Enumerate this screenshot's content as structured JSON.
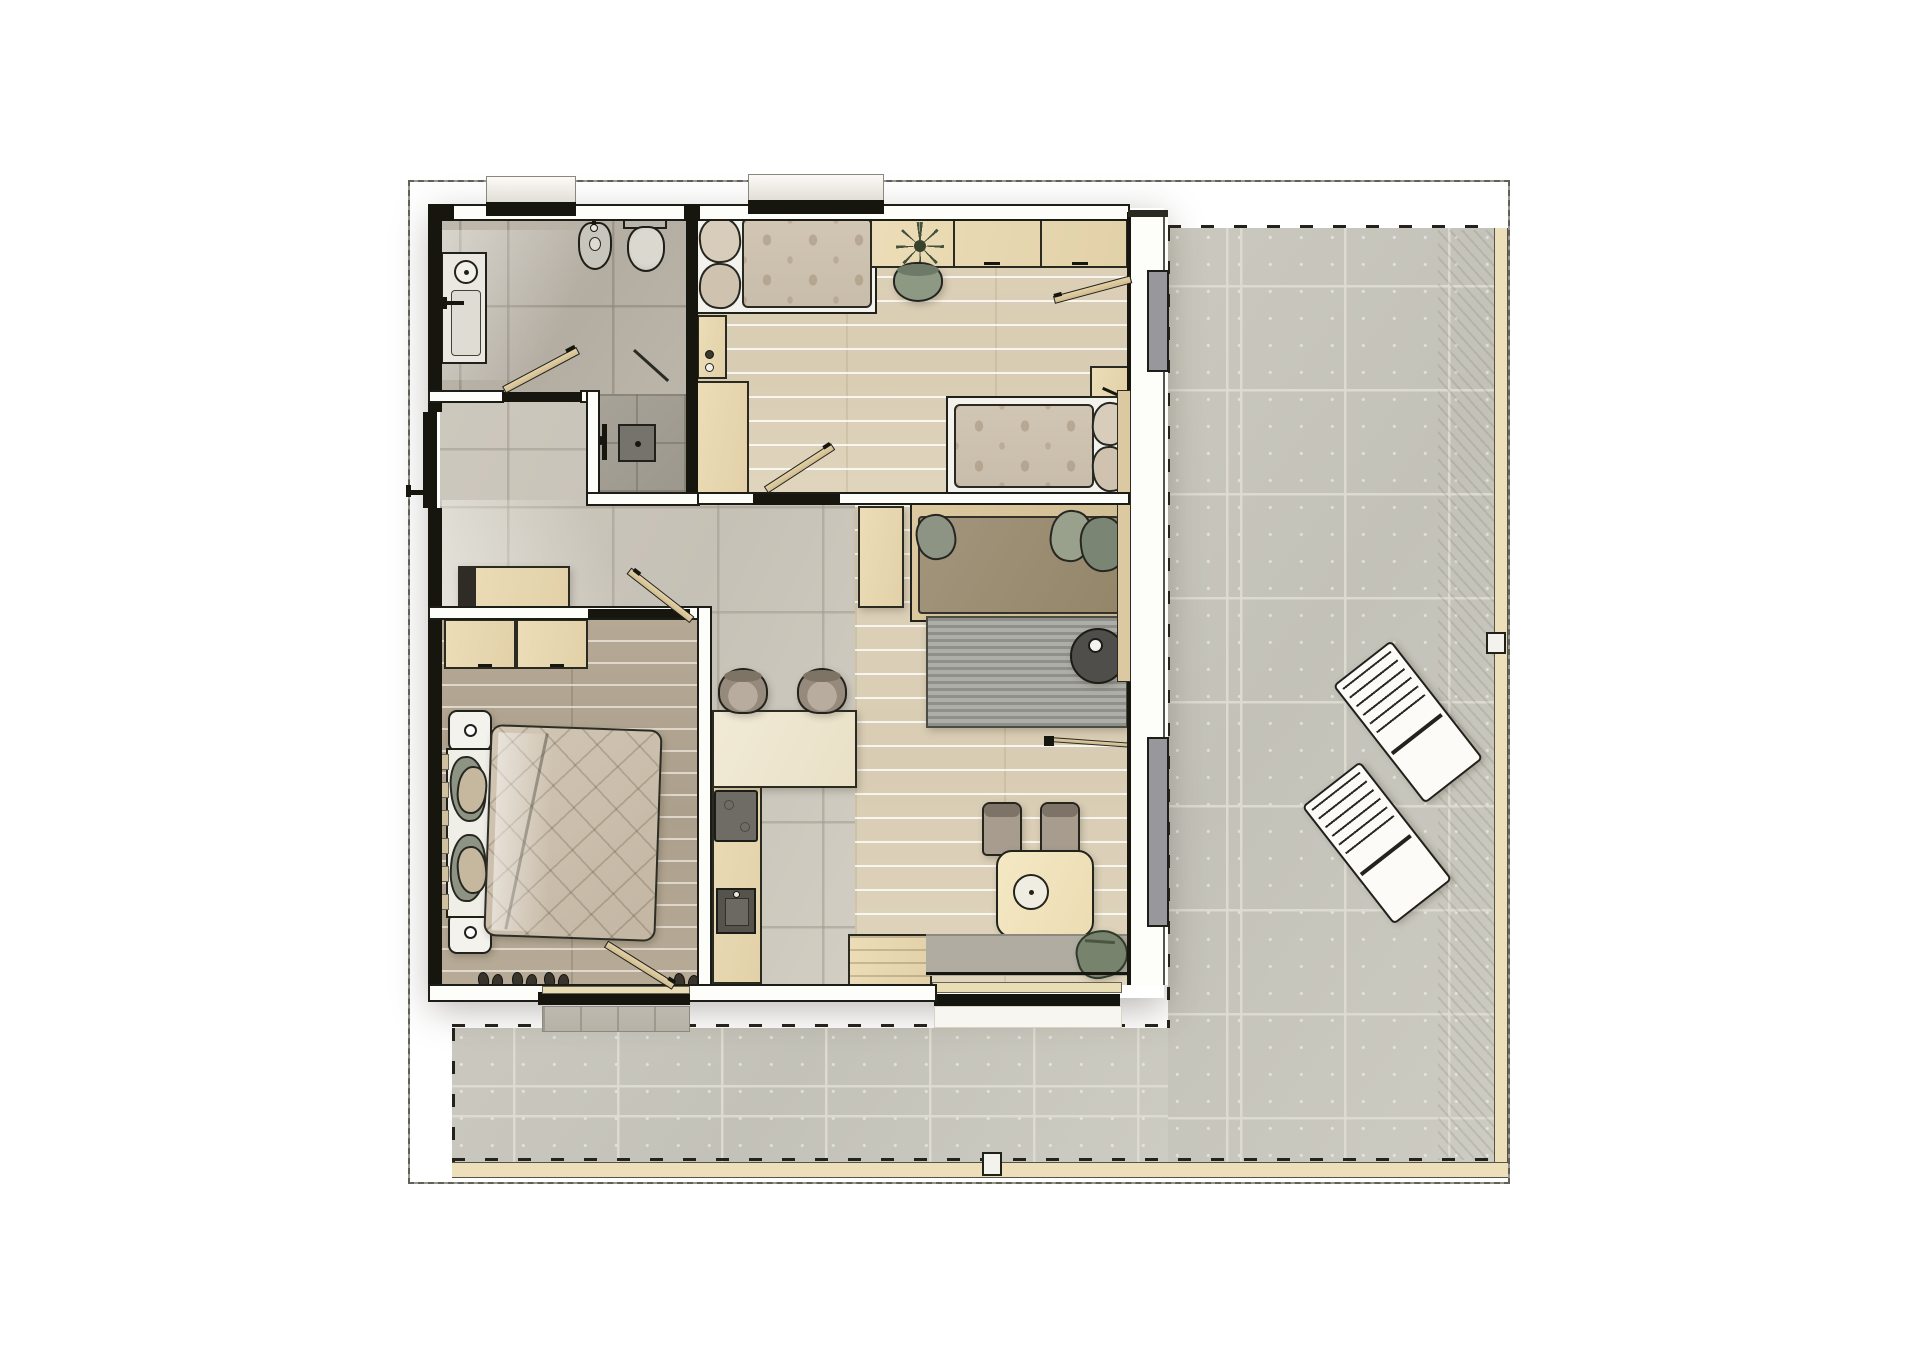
{
  "meta": {
    "content_type": "architectural-floor-plan-rendering",
    "view": "top-down color sketch render of an apartment with wrap-around terrace",
    "visible_text": "none"
  },
  "palette": {
    "paper": "#ffffff",
    "wall_black": "#16160f",
    "wall_white": "#fdfdfa",
    "interior_tile": "#c9c4b9",
    "bathroom_tile": "#b6b0a5",
    "shower_tile": "#a09b91",
    "oak_floor_light": "#dbcfb7",
    "oak_floor_dark": "#b2a692",
    "terrace_tile": "#c8c6bc",
    "terrace_edge_wood": "#ecdfba",
    "furniture_wood": "#e8d9b5",
    "counter_cream": "#efe8d2",
    "cushion_sage": "#8d9484",
    "cushion_taupe": "#9b8d76",
    "rug_gray": "#a3a39d",
    "slider_panel_gray": "#98979b",
    "lounger_white": "#fcfbf7",
    "sketch_line": "#23231d"
  },
  "apartment": {
    "rooms": [
      {
        "id": "bathroom",
        "floor": "gray-stone-tile",
        "items": [
          "vanity-counter-with-round-sink",
          "wall-faucet",
          "bidet",
          "toilet",
          "walk-in-shower-tray",
          "shower-head",
          "glass-shower-door",
          "hinged-door-open"
        ]
      },
      {
        "id": "hallway-entry",
        "floor": "gray-stone-tile",
        "items": [
          "entry-door-leaf",
          "door-handle",
          "wood-sideboard"
        ]
      },
      {
        "id": "twin-bedroom",
        "floor": "light-oak-plank",
        "items": [
          "single-bed-top",
          "single-bed-right",
          "pillow-stack",
          "patterned-duvets",
          "wardrobe-cabinets-left",
          "knob-handles",
          "desk-cabinet-run",
          "potted-plant",
          "desk-chair-sage",
          "bedside-cabinet",
          "door-to-hall-open",
          "terrace-door-open"
        ]
      },
      {
        "id": "master-bedroom",
        "floor": "smoked-oak-plank",
        "items": [
          "double-bed",
          "white-sheet",
          "crumpled-quilt",
          "sage-pillows",
          "nightstand-with-lamp-top",
          "nightstand-with-lamp-bottom",
          "wardrobe-two-boxes",
          "headboard-slats",
          "slippers-row",
          "door-open",
          "sliding-door-to-terrace",
          "tiled-outdoor-step"
        ]
      },
      {
        "id": "kitchen",
        "floor": "gray-stone-tile",
        "items": [
          "counter-run-left",
          "cooktop-dark",
          "sink-dark",
          "island-counter-cream",
          "bar-stool-1",
          "bar-stool-2",
          "bench-cabinet"
        ]
      },
      {
        "id": "living-dining",
        "floor": "light-oak-plank",
        "items": [
          "wood-side-console",
          "daybed-sofa-wood-frame",
          "taupe-seat-cushion",
          "sage-scatter-cushions",
          "striped-gray-rug",
          "round-side-table-dark",
          "white-bowl-accent",
          "dining-table-rounded",
          "fruit-bowl",
          "dining-chair-1",
          "dining-chair-2",
          "olive-floor-cushion",
          "doormat",
          "sliding-glass-wall-panels",
          "door-pull-rod"
        ]
      }
    ]
  },
  "terrace": {
    "paving": "large-stone-tiles",
    "edges": [
      "timber-border-right",
      "timber-border-bottom",
      "dashed-sketch-outline",
      "pencil-frame"
    ],
    "items": [
      "sun-lounger-upper",
      "sun-lounger-lower",
      "edge-post-right",
      "edge-post-bottom"
    ]
  }
}
